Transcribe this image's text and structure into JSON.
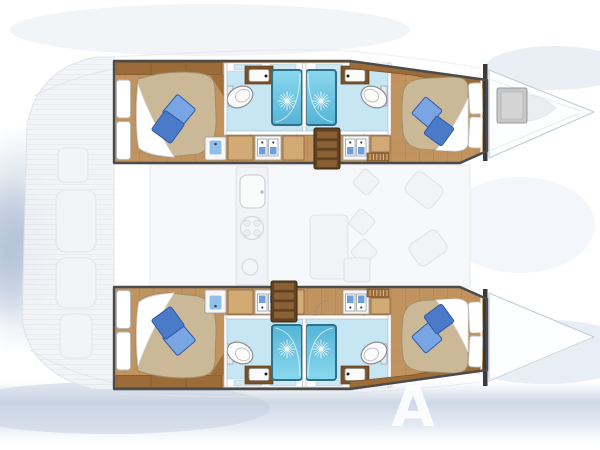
{
  "diagram": {
    "type": "boat-floorplan",
    "subject": "catamaran sailing yacht layout, top-down view, 4 cabins / 4 bathrooms",
    "watermark_letter": "A",
    "upper_hull": {
      "rooms": [
        "aft double cabin",
        "aft bathroom with shower",
        "forward bathroom with shower",
        "forward double cabin"
      ],
      "fixtures": [
        "double berth with blue pillows",
        "shower cubicle",
        "toilet",
        "washbasin",
        "wardrobe lockers with hangers",
        "companionway stairs",
        "bow deck hatch"
      ]
    },
    "lower_hull": {
      "rooms": [
        "aft double cabin",
        "aft bathroom with shower",
        "forward bathroom with shower",
        "forward double cabin"
      ],
      "fixtures": [
        "double berth with blue pillows",
        "shower cubicle",
        "toilet",
        "washbasin",
        "wardrobe lockers with hangers",
        "companionway stairs"
      ]
    },
    "saloon": {
      "style": "ghosted",
      "fixtures": [
        "galley sink",
        "stove",
        "saloon table",
        "seats"
      ]
    },
    "exterior": {
      "features": [
        "stern cockpit (ghosted)",
        "twin bows",
        "transom platform"
      ]
    }
  },
  "colors": {
    "wood": "#c1945f",
    "wood_dark": "#9c6c38",
    "plank": "#a07648",
    "hull_outline": "#4b4b4b",
    "mattress": "#cbb897",
    "mattress_edge": "#a08f6c",
    "pillow_light": "#79a5e2",
    "pillow_dark": "#4a7ac8",
    "pillow_edge": "#2d5aa8",
    "bath_floor": "#c6e6f4",
    "bath_window": "#cfe8f4",
    "shower_border": "#2e7089",
    "fixture_white": "#fbfbfb",
    "fixture_edge": "#8e8e8e",
    "counter": "#7a5126",
    "drawer_blue": "#6f9fd8",
    "basin_blue": "#8fc0ea",
    "hanger": "#b76b28",
    "stair_dark": "#5f4122",
    "stair_slat": "#8a6134",
    "wardrobe": "#d2ab74",
    "wardrobe_edge": "#8a6140",
    "ghost_fill": "#f2f3f6",
    "ghost_line": "#dfe2e6",
    "bow_line": "#c5ccd5",
    "hatch": "#c7c7c7",
    "haze": "#b3c2d8",
    "band": "#c9d5e4"
  }
}
